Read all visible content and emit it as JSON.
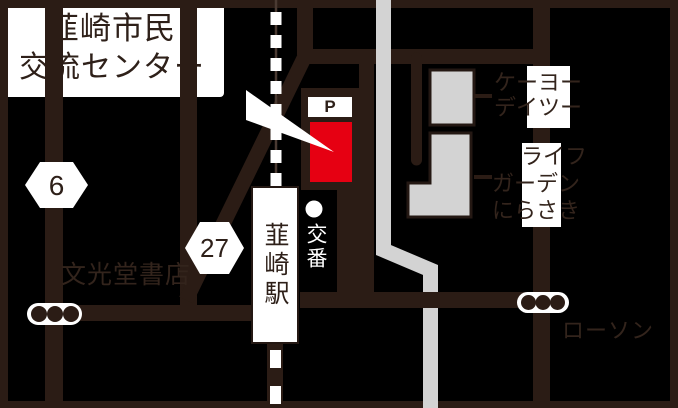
{
  "canvas": {
    "width": 678,
    "height": 408
  },
  "colors": {
    "background": "#000000",
    "road_brown": "#2b1c15",
    "text_dark": "#33241c",
    "destination_red": "#e60012",
    "building_gray": "#d3d3d3",
    "label_white": "#ffffff"
  },
  "callout": {
    "line1": "韮崎市民",
    "line2": "交流センター"
  },
  "badges": {
    "route6": "6",
    "route27": "27"
  },
  "parking": {
    "label": "P"
  },
  "station": {
    "name": "韮崎駅"
  },
  "police": {
    "name": "交番"
  },
  "stores": {
    "bookstore": "文光堂書店",
    "lawson": "ローソン",
    "keiyo_d2": {
      "line1": "ケーヨー",
      "line2": "デイツー"
    },
    "life_garden": {
      "line1": "ライフ",
      "line2": "ガーデン",
      "line3": "にらさき"
    }
  }
}
